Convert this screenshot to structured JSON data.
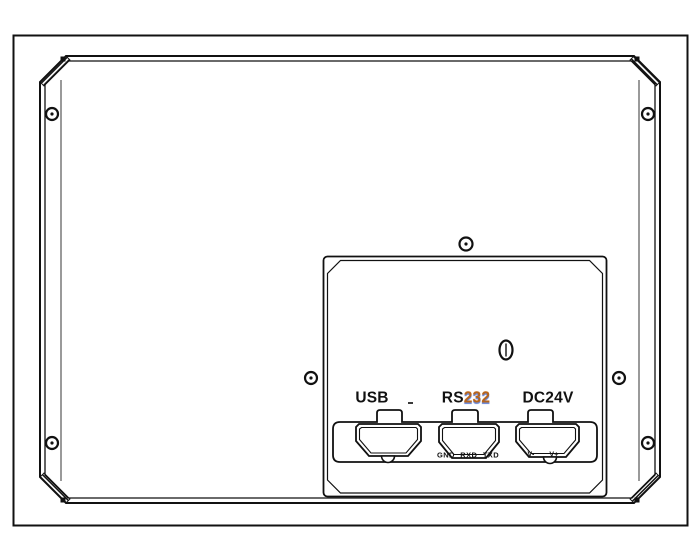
{
  "io_panel": {
    "ports": [
      {
        "id": "usb",
        "label": "USB"
      },
      {
        "id": "rs232",
        "label_prefix": "RS",
        "label_digits": "232"
      },
      {
        "id": "dc24v",
        "label": "DC24V"
      }
    ],
    "serial_pin_labels": "GND RXD TXD",
    "power_pin_negative": "V-",
    "power_pin_positive": "V+"
  },
  "colors": {
    "ink": "#111111",
    "seam": "#808080",
    "rs232_digits": "#b4641e",
    "rs232_fringe": "#4a6fd0",
    "background": "#ffffff"
  }
}
